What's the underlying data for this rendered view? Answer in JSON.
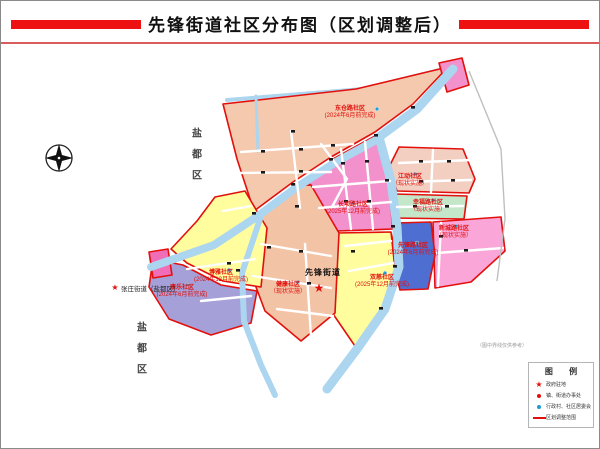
{
  "page": {
    "title": "先锋街道社区分布图（区划调整后）"
  },
  "map": {
    "district_label": "盐都区",
    "neighbor_street": "张庄街道（盐都区）",
    "street_office": "先锋街道",
    "note": "（图中界线仅供参考）",
    "regions": [
      {
        "id": "dongcanglu",
        "name": "东仓路社区",
        "note": "(2024年6月前完成)"
      },
      {
        "id": "changbalu",
        "name": "长坝路社区",
        "note": "(2025年12月前完成)"
      },
      {
        "id": "jiangdong",
        "name": "江动社区",
        "note": "（现状实施）"
      },
      {
        "id": "xingfulu",
        "name": "幸福路社区",
        "note": "（现状实施）"
      },
      {
        "id": "xinchenglu",
        "name": "新城路社区",
        "note": "（现状实施）"
      },
      {
        "id": "xianfenglu",
        "name": "先锋路社区",
        "note": "(2024年6月前完成)"
      },
      {
        "id": "shuangci",
        "name": "双慈社区",
        "note": "(2025年12月前完成)"
      },
      {
        "id": "jiankang",
        "name": "健康社区",
        "note": "（现状实施）"
      },
      {
        "id": "boya",
        "name": "博雅社区",
        "note": "(2024年12月前完成)"
      },
      {
        "id": "kangle",
        "name": "康乐社区",
        "note": "(2024年6月前完成)"
      }
    ]
  },
  "legend": {
    "title": "图 例",
    "items": [
      {
        "icon": "red-star-icon",
        "label": "政府驻地"
      },
      {
        "icon": "red-dot-icon",
        "label": "镇、街道办事处"
      },
      {
        "icon": "blue-dot-icon",
        "label": "行政村、社区居委会"
      },
      {
        "icon": "red-line-icon",
        "label": "区划调整范围"
      }
    ]
  },
  "colors": {
    "accent_red": "#e1100c",
    "header_bar_red": "#ee1111",
    "water_blue": "#acd5f0",
    "region_salmon": "#f4c9ae",
    "region_magenta": "#f291cb",
    "region_pink": "#fba6d9",
    "region_green": "#c4e6c9",
    "region_blue": "#4f6ed2",
    "region_yellow": "#fffd9e",
    "region_purple": "#a5a0d8",
    "community_dot_blue": "#1e9cd8"
  }
}
